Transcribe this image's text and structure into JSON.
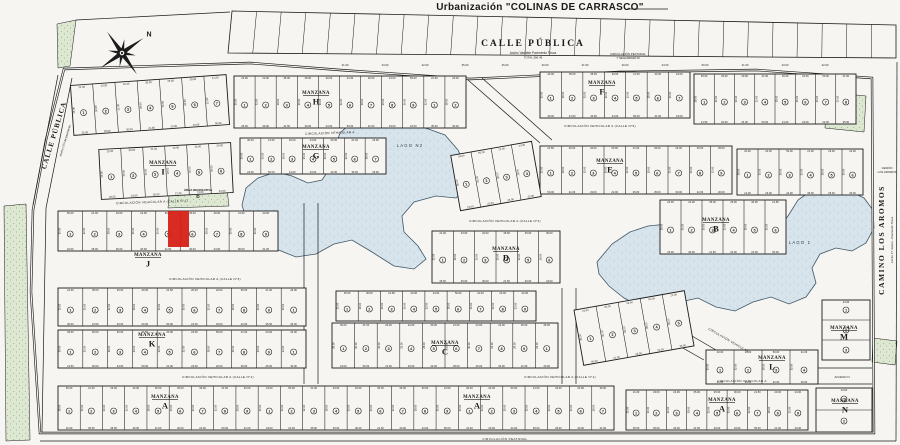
{
  "title": "Urbanización \"COLINAS DE CARRASCO\"",
  "colors": {
    "paper": "#f6f5f1",
    "ink": "#1b1b1b",
    "lake_fill": "#d8e4ec",
    "lake_dot": "#a8bfd0",
    "green_fill": "#dde7d2",
    "green_dot": "#93a878",
    "highlight": "#d62015"
  },
  "compass": {
    "north_label": "N",
    "cx": 122,
    "cy": 53,
    "rotation": -35
  },
  "boundary": "64,69 250,63 340,70 470,79 620,72 756,70 872,78 874,433 40,433 31,292 33,210 46,140",
  "neighbor_strip": {
    "x1": 232,
    "y1": 11,
    "x2": 896,
    "y2": 25,
    "x3": 896,
    "y3": 58,
    "x4": 228,
    "y4": 53,
    "divisions": 27
  },
  "top_street": {
    "name": "CALLE PÚBLICA",
    "sub1": "Ancho Variable Pavimento Tosca",
    "sub2": "TOTAL 596.45",
    "x": 533,
    "y": 46
  },
  "left_street": {
    "name": "CALLE PÚBLICA",
    "sub": "Ancho 17m de pavimento",
    "x": 56,
    "y": 136,
    "rot": -73
  },
  "right_street": {
    "name": "CAMINO LOS AROMOS",
    "sub": "Ancho 17 metros - Pavimento Tosca",
    "x": 884,
    "y": 240,
    "rot": -90
  },
  "corner_note": {
    "lines": [
      "CESIÓN",
      "LOS AROMOS"
    ],
    "x": 887,
    "y": 169
  },
  "acceso_note": {
    "text": "ACCESO N",
    "x": 842,
    "y": 378
  },
  "peatonal_top": {
    "line1": "CIRCULACIÓN PEATONAL",
    "line2": "Y SEGURIDAD M",
    "x": 628,
    "y": 55
  },
  "peatonal_bottom": {
    "text": "CIRCULACIÓN PEATONAL",
    "x": 505,
    "y": 440
  },
  "street_labels": [
    {
      "text": "CIRCULACIÓN VEHICULAR A   (CALLE N°5)",
      "x": 600,
      "y": 127,
      "rot": 0
    },
    {
      "text": "CIRCULACIÓN VEHICULAR A",
      "x": 330,
      "y": 134,
      "rot": -2
    },
    {
      "text": "CIRCULACIÓN VEHICULAR A   (CALLE N°1)",
      "x": 152,
      "y": 203,
      "rot": -2
    },
    {
      "text": "CIRCULACIÓN VEHICULAR A   (CALLE N°2)",
      "x": 505,
      "y": 222,
      "rot": 0
    },
    {
      "text": "CIRCULACIÓN VEHICULAR A   (CALLE N°3)",
      "x": 205,
      "y": 280,
      "rot": 0
    },
    {
      "text": "CIRCULACIÓN VEHICULAR A   (CALLE N°1)",
      "x": 218,
      "y": 378,
      "rot": 0
    },
    {
      "text": "CIRCULACIÓN VEHICULAR A   (CALLE N°1)",
      "x": 560,
      "y": 378,
      "rot": 0
    },
    {
      "text": "CIRCULACIÓN VEHICULAR A",
      "x": 742,
      "y": 382,
      "rot": 0
    },
    {
      "text": "CIRCULACIÓN VEHICULAR",
      "x": 728,
      "y": 341,
      "rot": 30
    }
  ],
  "lakes": [
    {
      "label": "LAGO N2",
      "name": "lake-lago-n2",
      "lx": 410,
      "ly": 147,
      "points": "392,120 420,126 445,135 458,150 466,168 468,185 456,198 436,196 414,202 402,216 404,232 418,246 426,259 414,269 394,266 372,252 352,240 334,244 316,254 296,257 276,249 258,237 247,222 242,205 246,188 258,178 276,172 292,176 308,183 322,180 330,168 334,150 340,133 352,122 370,117"
    },
    {
      "label": "LAGO 1",
      "name": "lake-lago-1",
      "lx": 800,
      "ly": 244,
      "points": "597,262 612,244 630,232 648,226 668,224 690,228 706,238 718,252 736,248 754,242 772,236 788,216 798,200 812,190 828,186 848,190 864,198 873,210 874,228 866,243 852,251 836,248 820,254 812,268 816,283 806,297 789,304 771,297 753,302 735,311 716,307 698,298 680,302 660,311 641,307 624,298 609,286 599,274"
    }
  ],
  "green_areas": [
    {
      "points": "57,24 76,20 70,66 58,68"
    },
    {
      "points": "827,92 866,96 864,132 825,128"
    },
    {
      "points": "4,206 26,204 30,440 6,441"
    },
    {
      "points": "873,338 897,341 895,365 872,362"
    },
    {
      "points": "170,184 226,181 229,206 168,208",
      "label": "ÁREA RECREATIVA",
      "letter": "D",
      "lx": 198,
      "ly": 191
    }
  ],
  "manzana_word": "MANZANA",
  "manzanas": [
    {
      "letter": "H",
      "x": 316,
      "y": 94
    },
    {
      "letter": "I",
      "x": 163,
      "y": 164
    },
    {
      "letter": "G",
      "x": 316,
      "y": 148
    },
    {
      "letter": "F",
      "x": 602,
      "y": 84
    },
    {
      "letter": "E",
      "x": 610,
      "y": 162
    },
    {
      "letter": "B",
      "x": 716,
      "y": 221
    },
    {
      "letter": "D",
      "x": 506,
      "y": 250
    },
    {
      "letter": "J",
      "x": 148,
      "y": 256
    },
    {
      "letter": "K",
      "x": 152,
      "y": 336
    },
    {
      "letter": "C",
      "x": 445,
      "y": 344
    },
    {
      "letter": "L",
      "x": 772,
      "y": 359
    },
    {
      "letter": "M",
      "x": 844,
      "y": 329
    },
    {
      "letter": "A",
      "x": 165,
      "y": 398
    },
    {
      "letter": "A",
      "x": 477,
      "y": 398
    },
    {
      "letter": "A",
      "x": 722,
      "y": 401
    },
    {
      "letter": "N",
      "x": 845,
      "y": 402
    }
  ],
  "blocks": [
    [
      72,
      80,
      156,
      50,
      7,
      -4
    ],
    [
      234,
      76,
      232,
      52,
      11,
      0
    ],
    [
      540,
      72,
      150,
      46,
      7,
      0
    ],
    [
      694,
      74,
      162,
      50,
      8,
      0
    ],
    [
      100,
      146,
      132,
      50,
      6,
      -3
    ],
    [
      240,
      138,
      146,
      36,
      7,
      0
    ],
    [
      540,
      146,
      192,
      48,
      9,
      0
    ],
    [
      737,
      149,
      126,
      46,
      6,
      0
    ],
    [
      455,
      148,
      82,
      56,
      4,
      -10
    ],
    [
      58,
      211,
      220,
      40,
      9,
      0
    ],
    [
      432,
      231,
      128,
      52,
      6,
      0
    ],
    [
      660,
      200,
      126,
      54,
      6,
      0
    ],
    [
      58,
      288,
      248,
      38,
      10,
      0
    ],
    [
      58,
      330,
      248,
      38,
      10,
      0
    ],
    [
      336,
      291,
      200,
      30,
      9,
      0
    ],
    [
      332,
      323,
      226,
      45,
      10,
      0
    ],
    [
      578,
      300,
      112,
      56,
      5,
      -10
    ],
    [
      706,
      350,
      112,
      34,
      4,
      0
    ],
    [
      822,
      300,
      48,
      60,
      3,
      0,
      1
    ],
    [
      58,
      386,
      556,
      44,
      25,
      0
    ],
    [
      626,
      390,
      182,
      40,
      9,
      0
    ],
    [
      816,
      388,
      56,
      44,
      2,
      0,
      1
    ]
  ],
  "highlight_lot": {
    "x": 168,
    "y": 211,
    "w": 21,
    "h": 36
  },
  "roads": [
    [
      58,
      75,
      33,
      205
    ],
    [
      72,
      78,
      46,
      208
    ],
    [
      46,
      208,
      42,
      432
    ],
    [
      304,
      203,
      304,
      384
    ],
    [
      318,
      203,
      318,
      384
    ],
    [
      562,
      288,
      562,
      384
    ],
    [
      576,
      288,
      576,
      384
    ],
    [
      468,
      80,
      540,
      143
    ],
    [
      482,
      78,
      552,
      140
    ],
    [
      630,
      318,
      704,
      360
    ],
    [
      644,
      308,
      716,
      350
    ],
    [
      808,
      368,
      872,
      368
    ],
    [
      808,
      384,
      872,
      384
    ],
    [
      897,
      62,
      896,
      441
    ],
    [
      40,
      441,
      896,
      441
    ],
    [
      627,
      9,
      668,
      9
    ],
    [
      76,
      20,
      230,
      12
    ]
  ],
  "dim_samples": [
    "21.00",
    "23.00",
    "22.00",
    "35.00",
    "25.00",
    "30.00",
    "21.50",
    "20.00",
    "24.00",
    "50.00"
  ],
  "depth_samples": [
    "35.00",
    "30.00",
    "32.00",
    "28.00"
  ],
  "top_dim_row": {
    "x": 345,
    "y": 66,
    "step": 40,
    "count": 13
  }
}
